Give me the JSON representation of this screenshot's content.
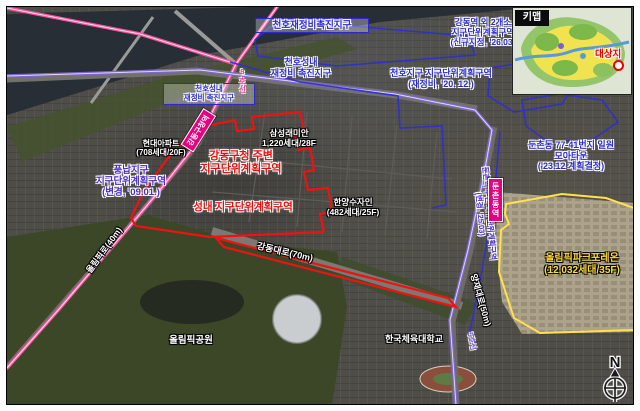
{
  "keymap": {
    "title": "키맵",
    "target_label": "대상지"
  },
  "districts": {
    "cheonho_promo_box": {
      "label": "천호재정비촉진지구"
    },
    "gangdong_station_zone": {
      "lines": [
        "강동역 외 2개소",
        "지구단위계획구역",
        "(신규지정, '26.03)"
      ]
    },
    "cheonho_seongnae_promo": {
      "lines": [
        "천호성내",
        "재정비 촉진지구"
      ]
    },
    "cheonho_seongnae_promo_boxed": {
      "lines": [
        "천호성내",
        "재정비 촉진지구"
      ]
    },
    "cheonho_district": {
      "lines": [
        "천호지구 지구단위계획구역",
        "(재정비, '20. 12.)"
      ]
    },
    "pungnap_district": {
      "lines": [
        "풍납지구",
        "지구단위계획구역",
        "(변경, '09.01.)"
      ]
    },
    "gangdong_office_zone": {
      "lines": [
        "강동구청 주변",
        "지구단위계획구역"
      ]
    },
    "seongnae_zone": {
      "label": "성내 지구단위계획구역"
    },
    "dunchon_moa_town": {
      "lines": [
        "둔촌동 77-41번지 일원",
        "모아타운",
        "('23.12 계획결정)"
      ]
    },
    "dunchon_station_zone": {
      "lines": [
        "둔촌역 주변 지구단위계획구역",
        "(변경, '25.03)"
      ]
    }
  },
  "apartments": {
    "hyundai": {
      "lines": [
        "현대아파트",
        "(708세대/20F)"
      ]
    },
    "samsung_raemian": {
      "lines": [
        "삼성래미안",
        "1,220세대/28F"
      ]
    },
    "hanyang_sujain": {
      "lines": [
        "한양수자인",
        "(482세대/25F)"
      ]
    },
    "olympic_park_foreon": {
      "lines": [
        "올림픽파크포레온",
        "(12,032세대/35F)"
      ]
    }
  },
  "roads": {
    "olympic_ro": "올림픽로(40m)",
    "gangdong_daero": "강동대로(70m)",
    "yangjae_daero": "양재대로(50m)"
  },
  "transit": {
    "gangdong_office_station": "강동구청역",
    "dunchon_station": "둔촌동역",
    "line8": "8호선",
    "line5": "5호선"
  },
  "places": {
    "olympic_park": "올림픽공원",
    "korea_national_sport_university": "한국체육대학교"
  },
  "compass": {
    "north": "N"
  },
  "colors": {
    "line8_pink": "#f4539f",
    "line5_purple": "#7e67cb",
    "boundary_blue": "#2f2fd0",
    "boundary_red": "#ee1313",
    "boundary_yellow": "#ffe14d",
    "station_magenta": "#e6007e"
  }
}
